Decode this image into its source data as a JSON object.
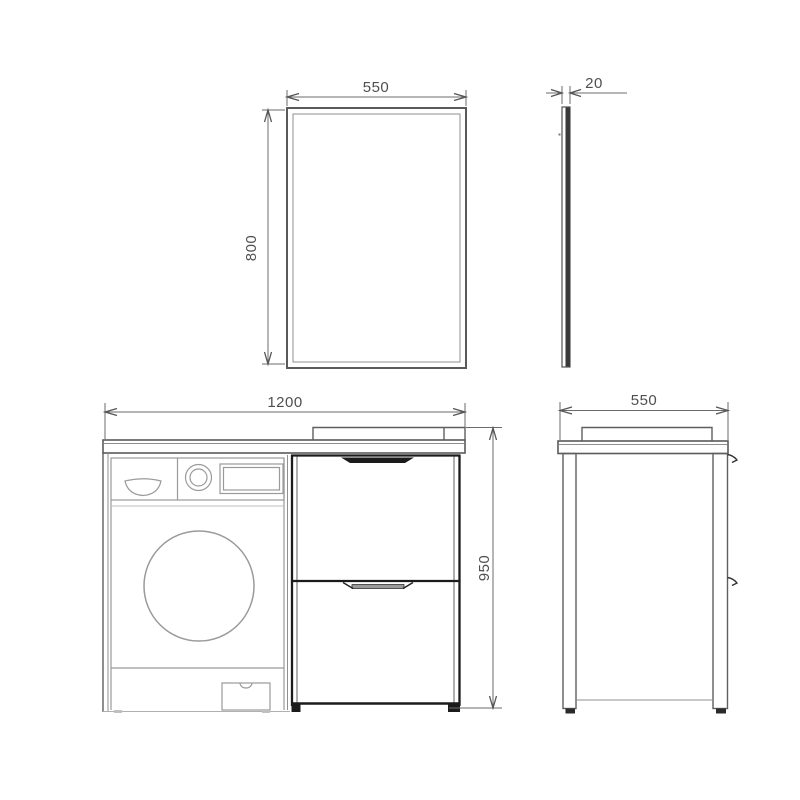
{
  "drawing": {
    "type": "technical-dimension-drawing",
    "subject": "bathroom mirror and washer vanity cabinet",
    "colors": {
      "background": "#ffffff",
      "line": "#6b6b6b",
      "light_line": "#9a9a9a",
      "dark_line": "#1b1b1b",
      "dimension_text": "#4f4f4f",
      "mirror_edge_fill": "#3a3a3a",
      "handle_fill": "#9a9a9a"
    },
    "labels": {
      "mirror_width": "550",
      "mirror_height": "800",
      "mirror_depth": "20",
      "cabinet_width": "1200",
      "cabinet_height": "950",
      "cabinet_depth": "550"
    }
  }
}
